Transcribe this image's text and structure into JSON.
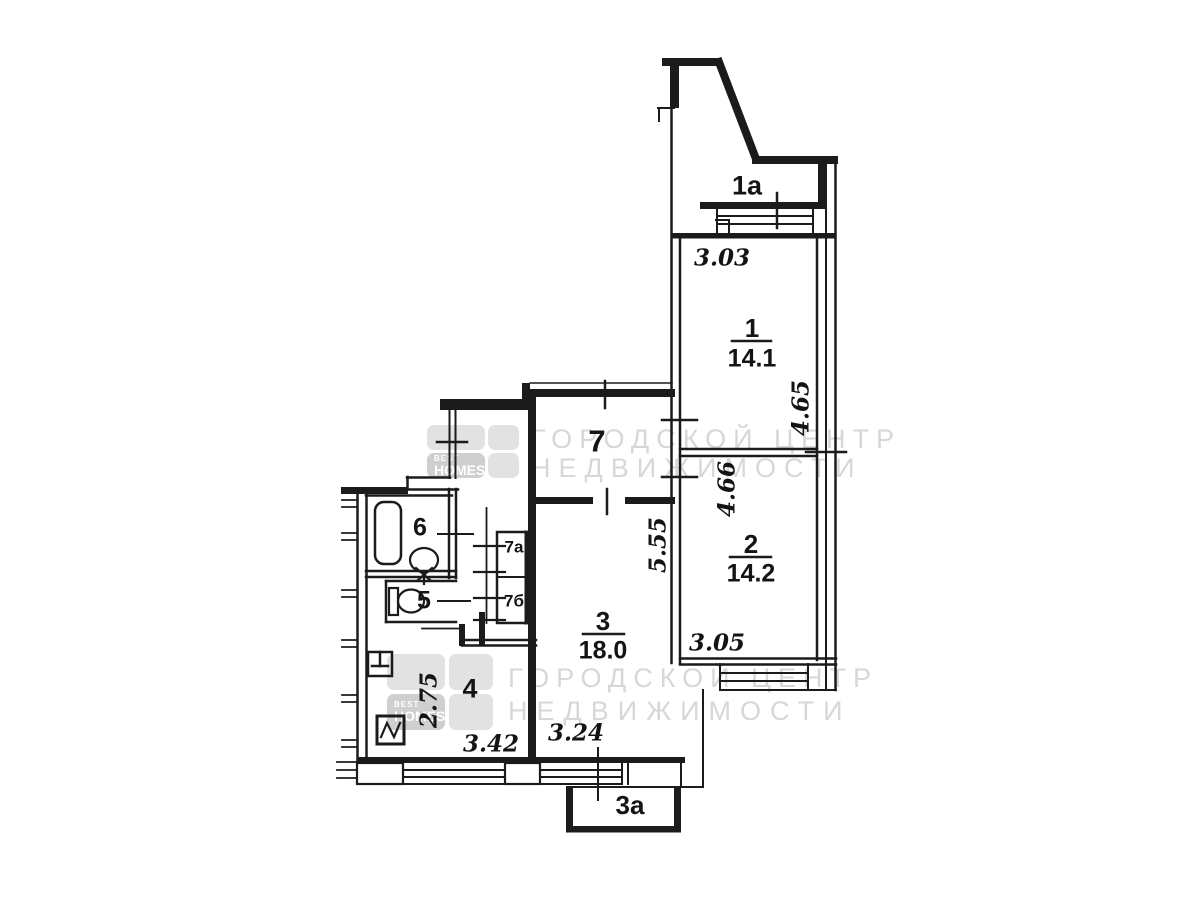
{
  "rooms": {
    "balcony_top": {
      "label": "1а"
    },
    "room1": {
      "number": "1",
      "area": "14.1",
      "dim_width": "3.03",
      "dim_height": "4.65"
    },
    "room2": {
      "number": "2",
      "area": "14.2",
      "dim_width": "3.05",
      "dim_height": "4.66"
    },
    "room3": {
      "number": "3",
      "area": "18.0",
      "dim_width": "3.24",
      "dim_height": "5.55"
    },
    "kitchen": {
      "number": "4",
      "dim_width": "3.42",
      "dim_height": "2.75"
    },
    "toilet": {
      "number": "5"
    },
    "bathroom": {
      "number": "6"
    },
    "hall": {
      "number": "7"
    },
    "closet_a": {
      "label": "7а"
    },
    "closet_b": {
      "label": "7б"
    },
    "balcony_bottom": {
      "label": "3а"
    }
  },
  "watermark": {
    "line1": "ГОРОДСКОЙ ЦЕНТР",
    "line2": "НЕДВИЖИМОСТИ",
    "brand_top": "BEST",
    "brand_bottom": "HOMES"
  },
  "colors": {
    "wall": "#1b1b1b",
    "background": "#ffffff",
    "watermark_text": "#d7d7d7",
    "watermark_tile": "#e2e2e2",
    "watermark_tile_dark": "#cfcfcf"
  }
}
